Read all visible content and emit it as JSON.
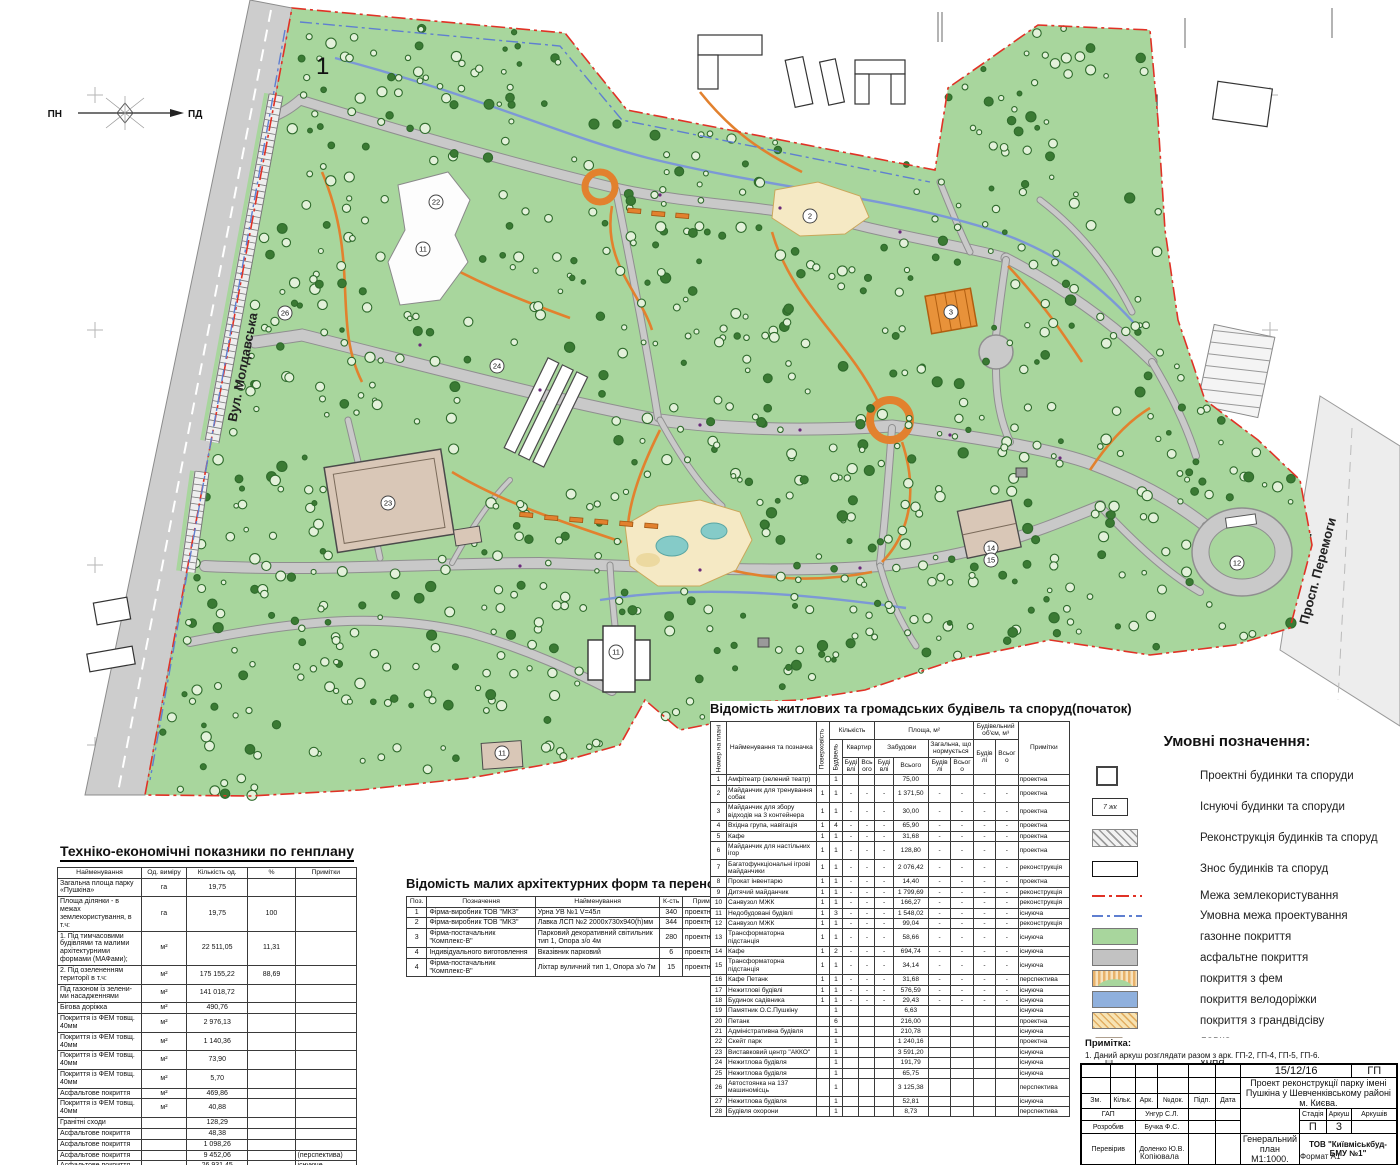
{
  "map": {
    "big_label": "1",
    "compass": {
      "north": "ПН",
      "south": "ПД"
    },
    "streets": {
      "left": "Вул. Молдавська",
      "right": "Просп. Перемоги"
    },
    "plan_labels": [
      {
        "t": "2",
        "x": 810,
        "y": 216
      },
      {
        "t": "3",
        "x": 951,
        "y": 312
      },
      {
        "t": "11",
        "x": 423,
        "y": 249
      },
      {
        "t": "11",
        "x": 616,
        "y": 652
      },
      {
        "t": "11",
        "x": 502,
        "y": 753
      },
      {
        "t": "12",
        "x": 1237,
        "y": 563
      },
      {
        "t": "14",
        "x": 991,
        "y": 548
      },
      {
        "t": "15",
        "x": 991,
        "y": 560
      },
      {
        "t": "22",
        "x": 436,
        "y": 202
      },
      {
        "t": "23",
        "x": 388,
        "y": 503
      },
      {
        "t": "24",
        "x": 497,
        "y": 366
      },
      {
        "t": "26",
        "x": 285,
        "y": 313
      }
    ],
    "palette": {
      "lawn": "#a8d69d",
      "tree_line": "#2f6b2c",
      "tree_fill": "#e3f1da",
      "tree_dark": "#3a7a33",
      "road": "#c9c9c9",
      "road_edge": "#8f8f8f",
      "path_orange": "#e2812e",
      "bike": "#7c98d6",
      "boundary_red": "#e03226",
      "boundary_blue": "#5f7fd0",
      "building_tan": "#d9c7b7",
      "playground": "#f5e9c4",
      "pond": "#85cbc8",
      "orange_building": "#e8923a"
    }
  },
  "tech_table": {
    "title": "Техніко-економічні показники по генплану",
    "headers": [
      "Найменування",
      "Од. виміру",
      "Кількість од.",
      "%",
      "Примітки"
    ],
    "rows": [
      [
        "Загальна площа парку «Пушкіна»",
        "га",
        "19,75",
        "",
        ""
      ],
      [
        "Площа ділянки - в межах землекористування, в т.ч:",
        "га",
        "19,75",
        "100",
        ""
      ],
      [
        "1. Під тимчасовими будівлями та малими архітектурними формами (МАФами);",
        "м²",
        "22 511,05",
        "11,31",
        ""
      ],
      [
        "2. Під озелененням території в т.ч:",
        "м²",
        "175 155,22",
        "88,69",
        ""
      ],
      [
        "Під газоном із зелени-ми насадженнями",
        "м²",
        "141 018,72",
        "",
        ""
      ],
      [
        "Бігова доріжка",
        "м²",
        "490,76",
        "",
        ""
      ],
      [
        "Покриття із ФЕМ товщ. 40мм",
        "м²",
        "2 976,13",
        "",
        ""
      ],
      [
        "Покриття із ФЕМ товщ. 40мм",
        "м²",
        "1 140,36",
        "",
        ""
      ],
      [
        "Покриття із ФЕМ товщ. 40мм",
        "м²",
        "73,90",
        "",
        ""
      ],
      [
        "Покриття із ФЕМ товщ. 40мм",
        "м²",
        "5,70",
        "",
        ""
      ],
      [
        "Асфальтове покриття",
        "м²",
        "469,86",
        "",
        ""
      ],
      [
        "Покриття із ФЕМ товщ. 40мм",
        "м²",
        "40,88",
        "",
        ""
      ],
      [
        "Гранітні сходи",
        "",
        "128,29",
        "",
        ""
      ],
      [
        "Асфальтове покриття",
        "",
        "48,38",
        "",
        ""
      ],
      [
        "Асфальтове покриття",
        "",
        "1 098,26",
        "",
        ""
      ],
      [
        "Асфальтове покриття",
        "",
        "9 452,06",
        "",
        "(перспектива)"
      ],
      [
        "Асфальтове покриття",
        "",
        "26 931,45",
        "",
        "існуюче"
      ],
      [
        "Гранітні плити",
        "",
        "1 139,55",
        "",
        "існуюче"
      ],
      [
        "Бігова доріжка",
        "",
        "1 917,13",
        "",
        "проект"
      ]
    ]
  },
  "maf_table": {
    "title": "Відомість малих архітектурних форм та переносних виробів",
    "headers": [
      "Поз.",
      "Позначення",
      "Найменування",
      "К-сть",
      "Примітка"
    ],
    "rows": [
      [
        "1",
        "Фірма-виробник ТОВ \"МКЗ\"",
        "Урна УВ №1 V=45л",
        "340",
        "проектна"
      ],
      [
        "2",
        "Фірма-виробник ТОВ \"МКЗ\"",
        "Лавка ЛСП №2 2000х730х940(h)мм",
        "344",
        "проектна"
      ],
      [
        "3",
        "Фірма-постачальник \"Комплекс-В\"",
        "Парковий декоративний світильник тип 1, Опора з/о 4м",
        "280",
        "проектна"
      ],
      [
        "4",
        "Індивідуального виготовлення",
        "Вказівник парковий",
        "6",
        "проектна"
      ],
      [
        "4",
        "Фірма-постачальник \"Комплекс-В\"",
        "Ліхтар вуличний тип 1, Опора з/о 7м",
        "15",
        "проектна"
      ]
    ]
  },
  "buildings_table": {
    "title": "Відомість житлових та громадських будівель та споруд(початок)",
    "header": {
      "num": "Номер на плані",
      "name": "Найменування та позначка",
      "floors": "Поверховість",
      "qty": "Кількість",
      "qty_buildings": "Будівель",
      "qty_apartments": "Квартир",
      "area": "Площа, м²",
      "area_built": "Забудови",
      "area_total": "Загальна, що нормується",
      "volume": "Будівельний об'єм, м³",
      "buildings": "Будівлі",
      "total": "Всього",
      "notes": "Примітки"
    },
    "rows": [
      [
        "1",
        "Амфітеатр (зелений театр)",
        "",
        "1",
        "",
        "",
        "",
        "75,00",
        "",
        "",
        "",
        "",
        "проектна"
      ],
      [
        "2",
        "Майданчик для тренування собак",
        "1",
        "1",
        "-",
        "-",
        "-",
        "1 371,50",
        "-",
        "-",
        "-",
        "-",
        "проектна"
      ],
      [
        "3",
        "Майданчик для збору відходів на 3 контейнера",
        "1",
        "1",
        "-",
        "-",
        "-",
        "30,00",
        "-",
        "-",
        "-",
        "-",
        "проектна"
      ],
      [
        "4",
        "Вхідна група, навігація",
        "1",
        "4",
        "-",
        "-",
        "-",
        "65,90",
        "-",
        "-",
        "-",
        "-",
        "проектна"
      ],
      [
        "5",
        "Кафе",
        "1",
        "1",
        "-",
        "-",
        "-",
        "31,68",
        "-",
        "-",
        "-",
        "-",
        "проектна"
      ],
      [
        "6",
        "Майданчик для настільних ігор",
        "1",
        "1",
        "-",
        "-",
        "-",
        "128,80",
        "-",
        "-",
        "-",
        "-",
        "проектна"
      ],
      [
        "7",
        "Багатофункціональні ігрові майданчики",
        "1",
        "1",
        "-",
        "-",
        "-",
        "2 076,42",
        "-",
        "-",
        "-",
        "-",
        "реконструкція"
      ],
      [
        "8",
        "Прокат інвентарю",
        "1",
        "1",
        "-",
        "-",
        "-",
        "14,40",
        "-",
        "-",
        "-",
        "-",
        "проектна"
      ],
      [
        "9",
        "Дитячий майданчик",
        "1",
        "1",
        "-",
        "-",
        "-",
        "1 799,69",
        "-",
        "-",
        "-",
        "-",
        "реконструкція"
      ],
      [
        "10",
        "Санвузол МЖК",
        "1",
        "1",
        "-",
        "-",
        "-",
        "166,27",
        "-",
        "-",
        "-",
        "-",
        "реконструкція"
      ],
      [
        "11",
        "Недобудовані будівлі",
        "1",
        "3",
        "-",
        "-",
        "-",
        "1 548,02",
        "-",
        "-",
        "-",
        "-",
        "існуюча"
      ],
      [
        "12",
        "Санвузол МЖК",
        "1",
        "1",
        "-",
        "-",
        "-",
        "99,04",
        "-",
        "-",
        "-",
        "-",
        "реконструкція"
      ],
      [
        "13",
        "Трансформаторна підстанція",
        "1",
        "1",
        "-",
        "-",
        "-",
        "58,66",
        "-",
        "-",
        "-",
        "-",
        "існуюча"
      ],
      [
        "14",
        "Кафе",
        "1",
        "2",
        "-",
        "-",
        "-",
        "694,74",
        "-",
        "-",
        "-",
        "-",
        "існуюча"
      ],
      [
        "15",
        "Трансформаторна підстанція",
        "1",
        "1",
        "-",
        "-",
        "-",
        "34,14",
        "-",
        "-",
        "-",
        "-",
        "існуюча"
      ],
      [
        "16",
        "Кафе Петанк",
        "1",
        "1",
        "-",
        "-",
        "-",
        "31,68",
        "-",
        "-",
        "-",
        "-",
        "перспектива"
      ],
      [
        "17",
        "Нежитлові будівлі",
        "1",
        "1",
        "-",
        "-",
        "-",
        "576,59",
        "-",
        "-",
        "-",
        "-",
        "існуюча"
      ],
      [
        "18",
        "Будинок садівника",
        "1",
        "1",
        "-",
        "-",
        "-",
        "29,43",
        "-",
        "-",
        "-",
        "-",
        "існуюча"
      ],
      [
        "19",
        "Памятник О.С.Пушкіну",
        "",
        "1",
        "",
        "",
        "",
        "6,63",
        "",
        "",
        "",
        "",
        "існуюча"
      ],
      [
        "20",
        "Петанк",
        "",
        "6",
        "",
        "",
        "",
        "216,00",
        "",
        "",
        "",
        "",
        "проектна"
      ],
      [
        "21",
        "Адміністративна будівля",
        "",
        "1",
        "",
        "",
        "",
        "210,78",
        "",
        "",
        "",
        "",
        "існуюча"
      ],
      [
        "22",
        "Скейт парк",
        "",
        "1",
        "",
        "",
        "",
        "1 240,16",
        "",
        "",
        "",
        "",
        "проектна"
      ],
      [
        "23",
        "Виставковий центр \"АККО\"",
        "",
        "1",
        "",
        "",
        "",
        "3 591,20",
        "",
        "",
        "",
        "",
        "існуюча"
      ],
      [
        "24",
        "Нежитлова будівля",
        "",
        "1",
        "",
        "",
        "",
        "191,79",
        "",
        "",
        "",
        "",
        "існуюча"
      ],
      [
        "25",
        "Нежитлова будівля",
        "",
        "1",
        "",
        "",
        "",
        "65,75",
        "",
        "",
        "",
        "",
        "існуюча"
      ],
      [
        "26",
        "Автостоянка на 137 машиномісць",
        "",
        "1",
        "",
        "",
        "",
        "3 125,38",
        "",
        "",
        "",
        "",
        "перспектива"
      ],
      [
        "27",
        "Нежитлова будівля",
        "",
        "1",
        "",
        "",
        "",
        "52,81",
        "",
        "",
        "",
        "",
        "існуюча"
      ],
      [
        "28",
        "Будівля охорони",
        "",
        "1",
        "",
        "",
        "",
        "8,73",
        "",
        "",
        "",
        "",
        "перспектива"
      ]
    ]
  },
  "legend": {
    "title": "Умовні позначення:",
    "exist_tag": "7 жк",
    "items": [
      {
        "swatch": "proj",
        "label": "Проектні будинки та споруди",
        "big": true
      },
      {
        "swatch": "exist",
        "label": "Існуючі будинки та споруди",
        "big": true
      },
      {
        "swatch": "recon",
        "label": "Реконструкція будинків та споруд",
        "big": true
      },
      {
        "swatch": "demol",
        "label": "Знос будинків та споруд",
        "big": true
      },
      {
        "swatch": "redline",
        "label": "Межа землекористування"
      },
      {
        "swatch": "blueline",
        "label": "Умовна межа  проектування"
      },
      {
        "swatch": "lawn",
        "label": "газонне покриття"
      },
      {
        "swatch": "asphalt",
        "label": "асфальтне покриття"
      },
      {
        "swatch": "fem",
        "label": "покриття з фем"
      },
      {
        "swatch": "bike",
        "label": "покриття велодоріжки"
      },
      {
        "swatch": "gravel",
        "label": "покриття з грандвідсіву"
      },
      {
        "swatch": "bench",
        "label": "лавка"
      },
      {
        "swatch": "urn",
        "label": "урна"
      },
      {
        "swatch": "lamp",
        "label": "ліхтар"
      }
    ]
  },
  "note": {
    "title": "Примітка:",
    "lines": [
      "1. Даний аркуш розглядати разом з арк. ГП-2, ГП-4, ГП-5, ГП-6."
    ]
  },
  "titleblock": {
    "date": "15/12/16",
    "code": "ГП",
    "project": "Проект реконструкції парку імені Пушкіна у Шевченківському районі м. Києва.",
    "cols": [
      "Зм.",
      "Кільк.",
      "Арк.",
      "№док.",
      "Підп.",
      "Дата"
    ],
    "roles": [
      {
        "role": "ГАП",
        "name": "Унгур С.Л."
      },
      {
        "role": "Розробив",
        "name": "Бучка Ф.С."
      },
      {
        "role": "Перевірив",
        "name": "Доленко Ю.В."
      }
    ],
    "stage_label": "Стадія",
    "sheet_label": "Аркуш",
    "sheets_label": "Аркушів",
    "stage": "П",
    "sheet": "3",
    "sheets": "",
    "doc": "Генеральний план М1:1000.",
    "org": "ТОВ \"Київміськбуд-БМУ №1\"",
    "copy": "Копіювала",
    "format": "Формат А1"
  }
}
